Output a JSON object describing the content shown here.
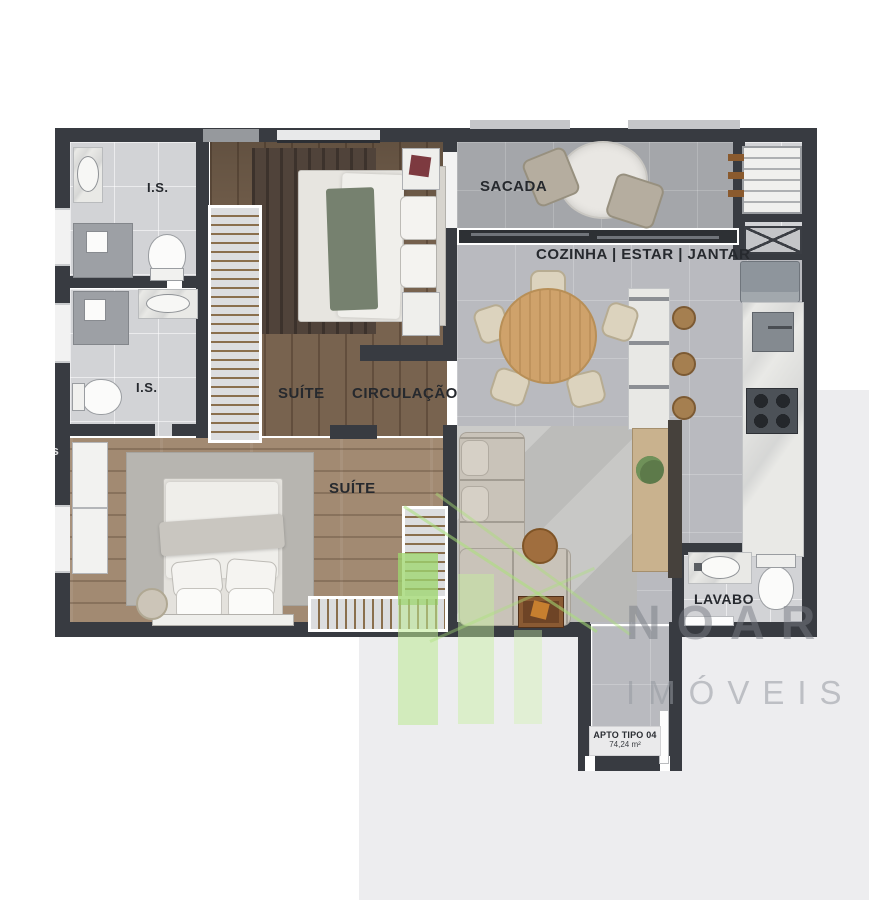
{
  "plan": {
    "unit_label": "APTO TIPO 04",
    "unit_area": "74,24 m²",
    "rooms": {
      "bathroom1": "I.S.",
      "bathroom2": "I.S.",
      "sacada": "SACADA",
      "kitchen_living": "COZINHA | ESTAR | JANTAR",
      "suite_upper": "SUÍTE",
      "circulation": "CIRCULAÇÃO",
      "suite_lower": "SUÍTE",
      "lavabo": "LAVABO"
    }
  },
  "watermark": {
    "brand": "NOAR",
    "sub": "IMÓVEIS",
    "edge_fragment": "is"
  },
  "colors": {
    "wall": "#383b41",
    "wood_dark": "#78634f",
    "wood_light": "#a28a72",
    "tile_gray": "#b9babf",
    "bath_tile": "#d2d3d6",
    "marble": "#e9e9e6",
    "accent_green": "#a8d97e",
    "watermark_gray": "#85888f",
    "background_panel": "#ededef"
  }
}
